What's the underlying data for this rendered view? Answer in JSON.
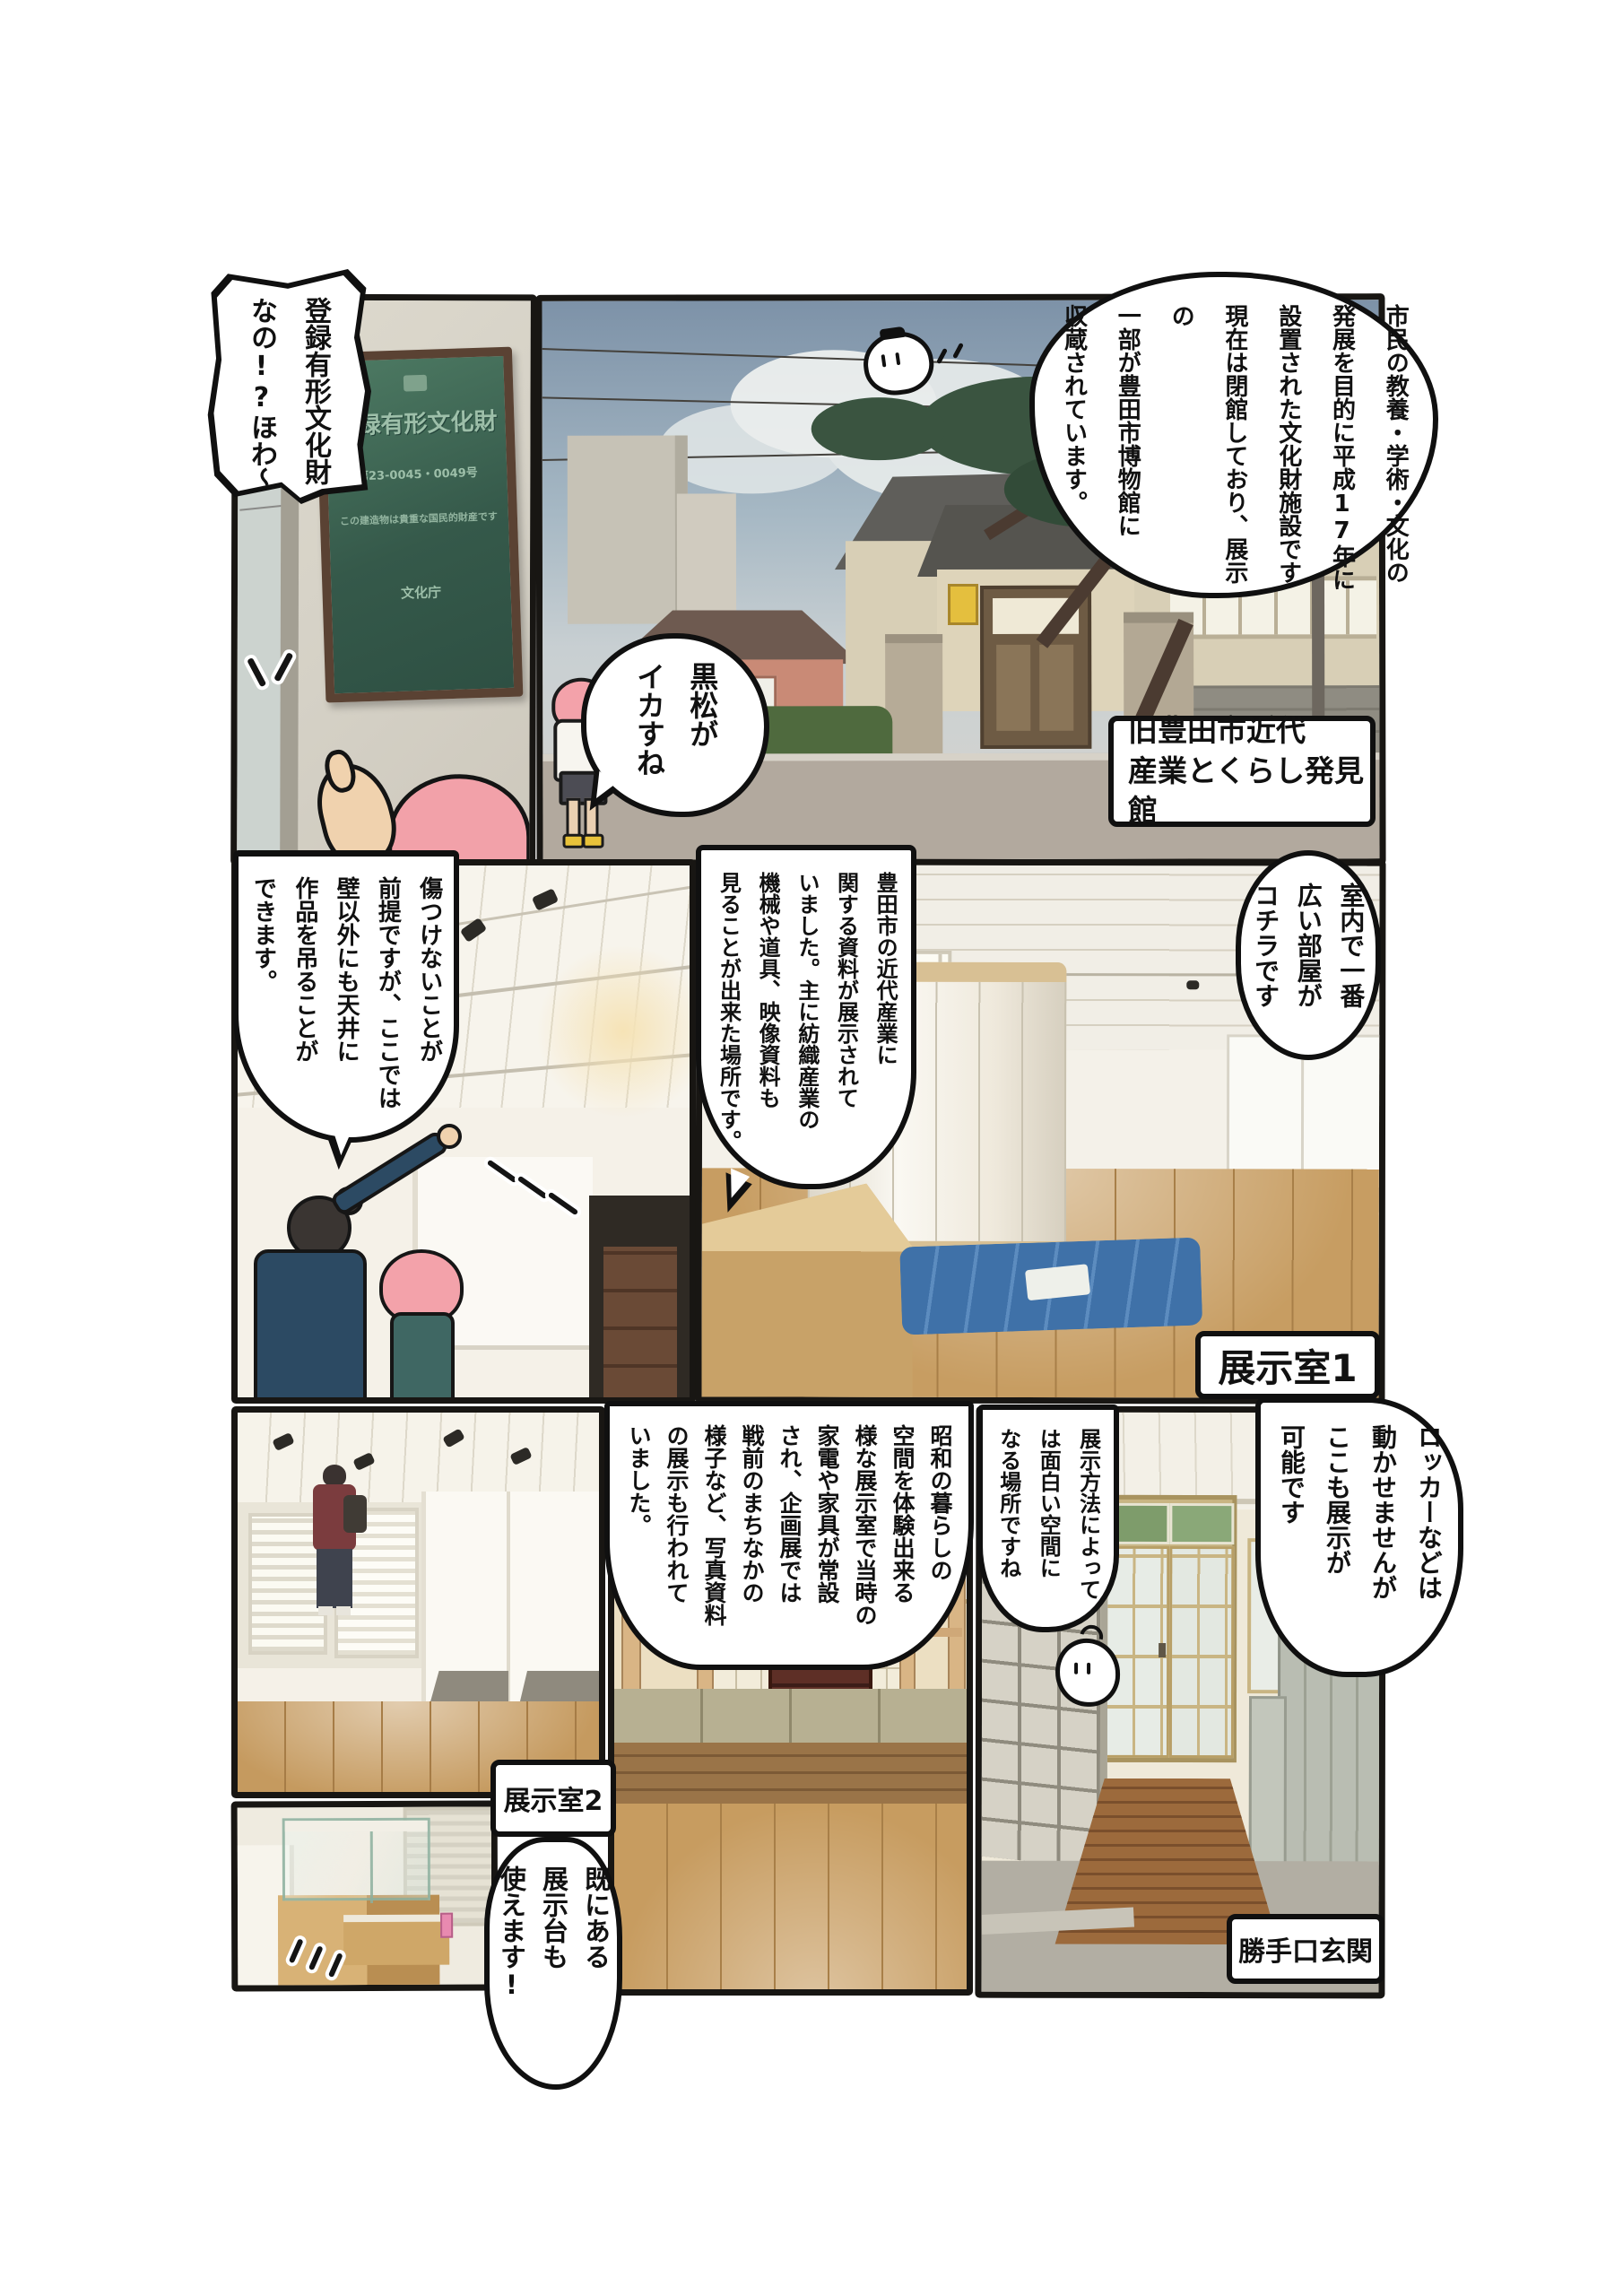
{
  "page": {
    "title": "旧豊田市近代産業とくらし発見館 ルポ漫画ページ",
    "colors": {
      "panel_border": "#181613",
      "bubble_bg": "#ffffff",
      "text": "#111111",
      "pink_hair": "#f2a1a9",
      "plaque_green": "#3f6a54",
      "sky_blue": "#7d92a8",
      "floor_wood": "#c79d62",
      "tarp_blue": "#3f71a8"
    }
  },
  "bubbles": {
    "intro": {
      "text": "市民の教養・学術・文化の\n発展を目的に平成17年に\n設置された文化財施設です\n現在は閉館しており、展示の\n一部が豊田市博物館に\n収蔵されています。"
    },
    "registered": {
      "text": "登録有形文化財\nなの!?ほわ〜"
    },
    "kuromatsu": {
      "text": "黒松が\nイカすね"
    },
    "widest_room": {
      "text": "室内で一番\n広い部屋が\nコチラです"
    },
    "industry": {
      "text": "豊田市の近代産業に\n関する資料が展示されて\nいました。主に紡織産業の\n機械や道具、映像資料も\n見ることが出来た場所です。"
    },
    "ceiling_hang": {
      "text": "傷つけないことが\n前提ですが、ここでは\n壁以外にも天井に\n作品を吊ることが\nできます。"
    },
    "showa": {
      "text": "昭和の暮らしの\n空間を体験出来る\n様な展示室で当時の\n家電や家具が常設\nされ、企画展では\n戦前のまちなかの\n様子など、写真資料\nの展示も行われて\nいました。"
    },
    "display_method": {
      "text": "展示方法によって\nは面白い空間に\nなる場所ですね"
    },
    "locker": {
      "text": "ロッカーなどは\n動かせませんが\nここも展示が\n可能です"
    },
    "pedestal": {
      "text": "既にある\n展示台も\n使えます!"
    }
  },
  "labels": {
    "building": {
      "text": "旧豊田市近代\n産業とくらし発見館"
    },
    "room1": {
      "text": "展示室1"
    },
    "room2": {
      "text": "展示室2"
    },
    "entrance": {
      "text": "勝手口玄関"
    }
  },
  "plaque": {
    "title": "登録有形文化財",
    "number": "第23-0045・0049号",
    "note": "この建造物は貴重な国民的財産です",
    "agency": "文化庁"
  }
}
